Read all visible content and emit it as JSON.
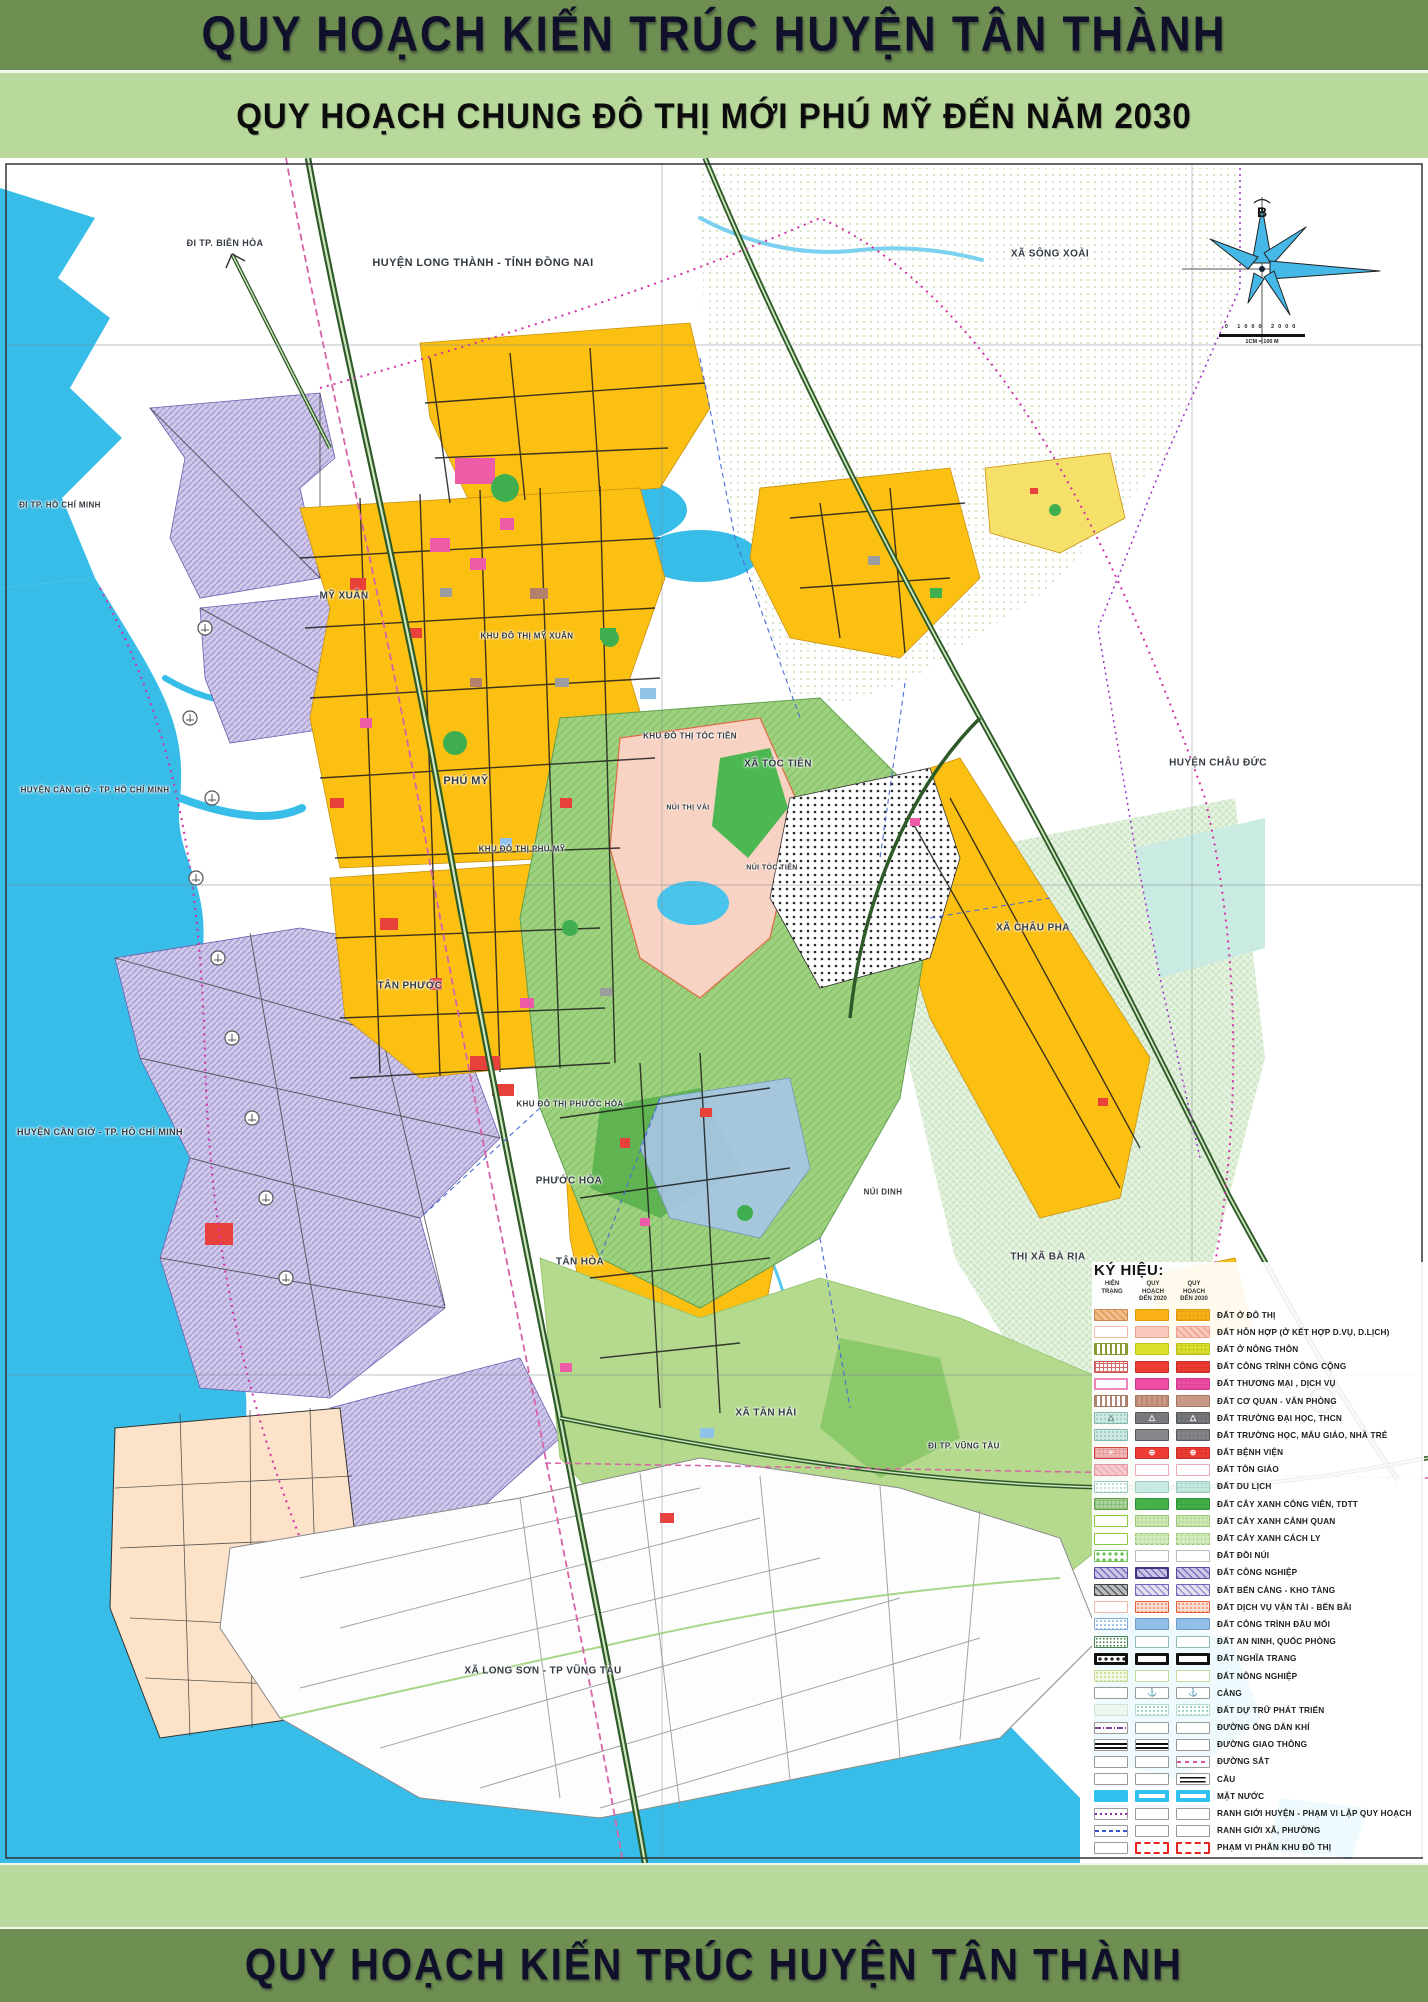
{
  "banners": {
    "top_title": "QUY HOẠCH KIẾN TRÚC HUYỆN TÂN THÀNH",
    "subtitle": "QUY HOẠCH CHUNG ĐÔ THỊ MỚI PHÚ MỸ ĐẾN NĂM 2030",
    "bottom_title": "QUY HOẠCH KIẾN TRÚC HUYỆN TÂN THÀNH"
  },
  "palette": {
    "banner_green": "#6e8f51",
    "subtitle_green": "#b9d89b",
    "water_blue": "#38bde9",
    "urban_yellow": "#fcc013",
    "industrial_lavender": "#d0c9e8",
    "forest_green": "#9ed17f",
    "boundary_magenta": "#d12fa6",
    "highway_green": "#2d5a27"
  },
  "compass": {
    "north_label": "B",
    "scale_ticks": "0  1000  2000",
    "scale_caption": "1CM = 100 M"
  },
  "map": {
    "labels": [
      {
        "text": "ĐI TP. BIÊN HÒA",
        "x": 225,
        "y": 243,
        "size": 9
      },
      {
        "text": "HUYỆN LONG THÀNH - TỈNH ĐỒNG NAI",
        "x": 483,
        "y": 263,
        "size": 11
      },
      {
        "text": "XÃ SÔNG XOÀI",
        "x": 1050,
        "y": 254,
        "size": 10
      },
      {
        "text": "ĐI TP. HỒ CHÍ MINH",
        "x": 60,
        "y": 505,
        "size": 8
      },
      {
        "text": "HUYỆN CẦN GIỜ - TP. HỒ CHÍ MINH",
        "x": 95,
        "y": 790,
        "size": 8
      },
      {
        "text": "HUYỆN CẦN GIỜ - TP. HỒ CHÍ MINH",
        "x": 100,
        "y": 1132,
        "size": 9
      },
      {
        "text": "HUYỆN CHÂU ĐỨC",
        "x": 1218,
        "y": 763,
        "size": 10
      },
      {
        "text": "MỸ XUÂN",
        "x": 344,
        "y": 596,
        "size": 10
      },
      {
        "text": "KHU ĐÔ THỊ MỸ XUÂN",
        "x": 527,
        "y": 636,
        "size": 8
      },
      {
        "text": "PHÚ MỸ",
        "x": 466,
        "y": 781,
        "size": 11
      },
      {
        "text": "KHU ĐÔ THỊ PHÚ MỸ",
        "x": 522,
        "y": 849,
        "size": 8
      },
      {
        "text": "XÃ TÓC TIÊN",
        "x": 778,
        "y": 764,
        "size": 10
      },
      {
        "text": "NÚI THỊ VẢI",
        "x": 688,
        "y": 808,
        "size": 7
      },
      {
        "text": "NÚI TÓC TIÊN",
        "x": 772,
        "y": 868,
        "size": 7
      },
      {
        "text": "KHU ĐÔ THỊ TÓC TIÊN",
        "x": 690,
        "y": 736,
        "size": 8
      },
      {
        "text": "XÃ CHÂU PHA",
        "x": 1033,
        "y": 928,
        "size": 10
      },
      {
        "text": "TÂN PHƯỚC",
        "x": 410,
        "y": 986,
        "size": 10
      },
      {
        "text": "KHU ĐÔ THỊ PHƯỚC HÒA",
        "x": 570,
        "y": 1104,
        "size": 8
      },
      {
        "text": "PHƯỚC HÒA",
        "x": 569,
        "y": 1181,
        "size": 10
      },
      {
        "text": "TÂN HÒA",
        "x": 580,
        "y": 1262,
        "size": 10
      },
      {
        "text": "NÚI DINH",
        "x": 883,
        "y": 1192,
        "size": 8
      },
      {
        "text": "THỊ XÃ BÀ RỊA",
        "x": 1048,
        "y": 1257,
        "size": 10
      },
      {
        "text": "XÃ TÂN HẢI",
        "x": 766,
        "y": 1413,
        "size": 10
      },
      {
        "text": "ĐI TP. VŨNG TÀU",
        "x": 964,
        "y": 1446,
        "size": 8
      },
      {
        "text": "XÃ LONG SƠN - TP VŨNG TÀU",
        "x": 543,
        "y": 1671,
        "size": 10
      }
    ]
  },
  "legend": {
    "heading": "KÝ HIỆU:",
    "columns": [
      "HIỆN TRẠNG",
      "QUY HOẠCH ĐẾN 2020",
      "QUY HOẠCH ĐẾN 2030"
    ],
    "rows": [
      {
        "label": "ĐẤT Ở ĐÔ THỊ",
        "swatches": [
          {
            "bg": "#f0bd8c",
            "pat": "hatch",
            "pc": "#df9a55",
            "bc": "#c98b4e"
          },
          {
            "bg": "#fbb216",
            "bc": "#d99a10"
          },
          {
            "bg": "#fbb216",
            "pat": "grid",
            "pc": "#e8a312",
            "bc": "#d99a10"
          }
        ]
      },
      {
        "label": "ĐẤT HỖN HỢP (Ở KẾT HỢP D.VỤ, D.LỊCH)",
        "swatches": [
          {
            "bg": "#ffffff",
            "bc": "#f3b8ab"
          },
          {
            "bg": "#f9c9bb",
            "bc": "#eba193"
          },
          {
            "bg": "#f9c9bb",
            "pat": "hatch",
            "pc": "#eca392",
            "bc": "#eba193"
          }
        ]
      },
      {
        "label": "ĐẤT Ở NÔNG THÔN",
        "swatches": [
          {
            "bg": "#ffffff",
            "pat": "vlines",
            "pc": "#8a9a33",
            "bc": "#8a9a33"
          },
          {
            "bg": "#dbe12c",
            "bc": "#b9c320"
          },
          {
            "bg": "#dbe12c",
            "pat": "grid",
            "pc": "#c6cd22",
            "bc": "#b9c320"
          }
        ]
      },
      {
        "label": "ĐẤT CÔNG TRÌNH CÔNG CỘNG",
        "swatches": [
          {
            "bg": "#ffffff",
            "pat": "grid",
            "pc": "#d96a6a",
            "bc": "#c65454"
          },
          {
            "bg": "#ee3d35",
            "bc": "#c52f28"
          },
          {
            "bg": "#ee3d35",
            "pat": "grid",
            "pc": "#dd342d",
            "bc": "#c52f28"
          }
        ]
      },
      {
        "label": "ĐẤT THƯƠNG MẠI , DỊCH VỤ",
        "swatches": [
          {
            "bg": "#ffffff",
            "bc": "#ef86bc",
            "bw": 2
          },
          {
            "bg": "#ee4fa4",
            "bc": "#d03a8d"
          },
          {
            "bg": "#ee4fa4",
            "pat": "grid",
            "pc": "#df4398",
            "bc": "#d03a8d"
          }
        ]
      },
      {
        "label": "ĐẤT CƠ QUAN - VĂN PHÒNG",
        "swatches": [
          {
            "bg": "#ffffff",
            "pat": "vlines",
            "pc": "#b08574",
            "bc": "#a1765f"
          },
          {
            "bg": "#c99887",
            "pat": "vlines",
            "pc": "#b9886f",
            "bc": "#a1765f"
          },
          {
            "bg": "#c99887",
            "bc": "#a1765f"
          }
        ]
      },
      {
        "label": "ĐẤT TRƯỜNG ĐẠI HỌC, THCN",
        "swatches": [
          {
            "bg": "#cfe8e3",
            "pat": "dots",
            "pc": "#9fd0c8",
            "bc": "#86b8ae",
            "sym": "△",
            "sc": "#4f7d74"
          },
          {
            "bg": "#77797c",
            "bc": "#55585a",
            "sym": "△",
            "sc": "#ffffff"
          },
          {
            "bg": "#77797c",
            "pat": "grid",
            "pc": "#6a6c6f",
            "bc": "#55585a",
            "sym": "△",
            "sc": "#ffffff"
          }
        ]
      },
      {
        "label": "ĐẤT TRƯỜNG HỌC, MẪU GIÁO, NHÀ TRẺ",
        "swatches": [
          {
            "bg": "#cfe8e3",
            "pat": "dots",
            "pc": "#9fd0c8",
            "bc": "#86b8ae"
          },
          {
            "bg": "#85878a",
            "bc": "#55585a"
          },
          {
            "bg": "#85878a",
            "pat": "grid",
            "pc": "#77797c",
            "bc": "#55585a"
          }
        ]
      },
      {
        "label": "ĐẤT BỆNH VIỆN",
        "swatches": [
          {
            "bg": "#f2b9b9",
            "pat": "grid",
            "pc": "#e79a9a",
            "bc": "#d04440",
            "sym": "+",
            "sc": "#ffffff"
          },
          {
            "bg": "#ee3d35",
            "bc": "#c52f28",
            "sym": "⊕",
            "sc": "#ffffff"
          },
          {
            "bg": "#ee3d35",
            "pat": "grid",
            "pc": "#dd342d",
            "bc": "#c52f28",
            "sym": "⊕",
            "sc": "#ffffff"
          }
        ]
      },
      {
        "label": "ĐẤT TÔN GIÁO",
        "swatches": [
          {
            "bg": "#f7c9cf",
            "pat": "hatch",
            "pc": "#eeaab4",
            "bc": "#e295a2"
          },
          {
            "bg": "#ffffff",
            "bc": "#f0a8b2"
          },
          {
            "bg": "#ffffff",
            "bc": "#f0a8b2"
          }
        ]
      },
      {
        "label": "ĐẤT DU LỊCH",
        "swatches": [
          {
            "bg": "#ffffff",
            "pat": "dots",
            "pc": "#bfe3db",
            "bc": "#9cc9c0"
          },
          {
            "bg": "#c8eae2",
            "bc": "#9cc9c0"
          },
          {
            "bg": "#c8eae2",
            "pat": "grid",
            "pc": "#b6dcd2",
            "bc": "#9cc9c0"
          }
        ]
      },
      {
        "label": "ĐẤT CÂY XANH CÔNG VIÊN, TDTT",
        "swatches": [
          {
            "bg": "#a9d39a",
            "pat": "grid",
            "pc": "#8cbf7b",
            "bc": "#5f9e4f"
          },
          {
            "bg": "#46b049",
            "bc": "#2f8f38"
          },
          {
            "bg": "#46b049",
            "pat": "grid",
            "pc": "#3da341",
            "bc": "#2f8f38"
          }
        ]
      },
      {
        "label": "ĐẤT CÂY XANH CẢNH QUAN",
        "swatches": [
          {
            "bg": "#ffffff",
            "bc": "#8cc63f"
          },
          {
            "bg": "#cde6b4",
            "pat": "dots",
            "pc": "#b5d898",
            "bc": "#9cc474"
          },
          {
            "bg": "#cde6b4",
            "pat": "dots",
            "pc": "#b5d898",
            "bc": "#9cc474"
          }
        ]
      },
      {
        "label": "ĐẤT CÂY XANH CÁCH LY",
        "swatches": [
          {
            "bg": "#ffffff",
            "bc": "#8cc63f"
          },
          {
            "bg": "#d9edc4",
            "pat": "grid",
            "pc": "#c2dfa6",
            "bc": "#9cc474",
            "bs": "dashed"
          },
          {
            "bg": "#d9edc4",
            "pat": "grid",
            "pc": "#c2dfa6",
            "bc": "#9cc474",
            "bs": "dashed"
          }
        ]
      },
      {
        "label": "ĐẤT ĐỒI NÚI",
        "swatches": [
          {
            "bg": "#ffffff",
            "pat": "bigdots",
            "pc": "#6fbf58",
            "bc": "#6fbf58"
          },
          {
            "bg": "#ffffff",
            "bc": "#bbbbbb"
          },
          {
            "bg": "#ffffff",
            "bc": "#bbbbbb"
          }
        ]
      },
      {
        "label": "ĐẤT CÔNG NGHIỆP",
        "swatches": [
          {
            "bg": "#cdc5e6",
            "pat": "hatch",
            "pc": "#7d6fbf",
            "bc": "#5b4ea0"
          },
          {
            "bg": "#cdc5e6",
            "pat": "hatch",
            "pc": "#7d6fbf",
            "bc": "#3f3580",
            "bw": 2
          },
          {
            "bg": "#cdc5e6",
            "pat": "hatch",
            "pc": "#7d6fbf",
            "bc": "#5b4ea0"
          }
        ]
      },
      {
        "label": "ĐẤT BẾN CẢNG - KHO TÀNG",
        "swatches": [
          {
            "bg": "#b9bcbf",
            "pat": "hatch",
            "pc": "#5a5e63",
            "bc": "#3c4043"
          },
          {
            "bg": "#e6e2f2",
            "pat": "hatch",
            "pc": "#9a8fd0",
            "bc": "#6f64b8"
          },
          {
            "bg": "#e6e2f2",
            "pat": "hatch",
            "pc": "#9a8fd0",
            "bc": "#6f64b8"
          }
        ]
      },
      {
        "label": "ĐẤT DỊCH VỤ VẬN TẢI - BẾN BÃI",
        "swatches": [
          {
            "bg": "#ffffff",
            "bc": "#f0b9a5"
          },
          {
            "bg": "#f8ddd0",
            "pat": "dots",
            "pc": "#ef9d7f",
            "bc": "#e4603d"
          },
          {
            "bg": "#f8ddd0",
            "pat": "dots",
            "pc": "#ef9d7f",
            "bc": "#e4603d"
          }
        ]
      },
      {
        "label": "ĐẤT CÔNG TRÌNH ĐẦU MỐI",
        "swatches": [
          {
            "bg": "#ffffff",
            "pat": "dots",
            "pc": "#9ec4ea",
            "bc": "#7fa8d4"
          },
          {
            "bg": "#92bfe8",
            "bc": "#6f9dc8"
          },
          {
            "bg": "#92bfe8",
            "bc": "#6f9dc8"
          }
        ]
      },
      {
        "label": "ĐẤT AN NINH, QUỐC PHÒNG",
        "swatches": [
          {
            "bg": "#ffffff",
            "pat": "speckle",
            "pc": "#4c7f52",
            "bc": "#4c7f52"
          },
          {
            "bg": "#ffffff",
            "bc": "#8fbcb2"
          },
          {
            "bg": "#ffffff",
            "bc": "#8fbcb2"
          }
        ]
      },
      {
        "label": "ĐẤT NGHĨA TRANG",
        "swatches": [
          {
            "bg": "#ffffff",
            "pat": "bigdots",
            "pc": "#222222",
            "bc": "#111111",
            "bw": 3
          },
          {
            "bg": "#ffffff",
            "bc": "#111111",
            "bw": 3
          },
          {
            "bg": "#ffffff",
            "bc": "#111111",
            "bw": 3
          }
        ]
      },
      {
        "label": "ĐẤT NÔNG NGHIỆP",
        "swatches": [
          {
            "bg": "#f4f9e4",
            "pat": "dots",
            "pc": "#cde29f",
            "bc": "#c4da9a"
          },
          {
            "bg": "#ffffff",
            "bc": "#c4da9a"
          },
          {
            "bg": "#ffffff",
            "bc": "#c4da9a"
          }
        ]
      },
      {
        "label": "CẢNG",
        "swatches": [
          {
            "bg": "#ffffff",
            "bc": "#999999"
          },
          {
            "bg": "#ffffff",
            "bc": "#999999",
            "sym": "⚓",
            "sc": "#2b3f9e"
          },
          {
            "bg": "#ffffff",
            "bc": "#999999",
            "sym": "⚓",
            "sc": "#2b3f9e"
          }
        ]
      },
      {
        "label": "ĐẤT DỰ TRỮ PHÁT TRIỂN",
        "swatches": [
          {
            "bg": "#eef7ef",
            "bc": "#cfe3cf"
          },
          {
            "bg": "#ffffff",
            "pat": "dots",
            "pc": "#9fd4c4",
            "bc": "#b9d9cd"
          },
          {
            "bg": "#ffffff",
            "pat": "dots",
            "pc": "#9fd4c4",
            "bc": "#b9d9cd"
          }
        ]
      },
      {
        "label": "ĐƯỜNG ỐNG DẪN KHÍ",
        "swatches": [
          {
            "bg": "#ffffff",
            "bc": "#999999",
            "pat": "gasline",
            "pc": "#7d3f98"
          },
          {
            "bg": "#ffffff",
            "bc": "#999999"
          },
          {
            "bg": "#ffffff",
            "bc": "#999999"
          }
        ]
      },
      {
        "label": "ĐƯỜNG GIAO THÔNG",
        "swatches": [
          {
            "bg": "#ffffff",
            "bc": "#999999",
            "pat": "roadsym",
            "pc": "#111111"
          },
          {
            "bg": "#ffffff",
            "bc": "#999999",
            "pat": "roadsym",
            "pc": "#111111"
          },
          {
            "bg": "#ffffff",
            "bc": "#999999"
          }
        ]
      },
      {
        "label": "ĐƯỜNG SẮT",
        "swatches": [
          {
            "bg": "#ffffff",
            "bc": "#999999"
          },
          {
            "bg": "#ffffff",
            "bc": "#999999"
          },
          {
            "bg": "#ffffff",
            "bc": "#999999",
            "pat": "raildash",
            "pc": "#e0529e"
          }
        ]
      },
      {
        "label": "CẦU",
        "swatches": [
          {
            "bg": "#ffffff",
            "bc": "#999999"
          },
          {
            "bg": "#ffffff",
            "bc": "#999999"
          },
          {
            "bg": "#ffffff",
            "bc": "#999999",
            "pat": "bridgesym",
            "pc": "#111111"
          }
        ]
      },
      {
        "label": "MẶT NƯỚC",
        "swatches": [
          {
            "bg": "#2fc1ef",
            "bc": "#2fc1ef",
            "bw": 2
          },
          {
            "bg": "#ffffff",
            "bc": "#2fc1ef",
            "bw": 4
          },
          {
            "bg": "#ffffff",
            "bc": "#2fc1ef",
            "bw": 4
          }
        ]
      },
      {
        "label": "RANH GIỚI HUYỆN - PHẠM VI LẬP QUY HOẠCH",
        "swatches": [
          {
            "bg": "#ffffff",
            "bc": "#999999",
            "pat": "dotline",
            "pc": "#8a2fa8"
          },
          {
            "bg": "#ffffff",
            "bc": "#999999"
          },
          {
            "bg": "#ffffff",
            "bc": "#999999"
          }
        ]
      },
      {
        "label": "RANH GIỚI XÃ, PHƯỜNG",
        "swatches": [
          {
            "bg": "#ffffff",
            "bc": "#999999",
            "pat": "dashline",
            "pc": "#3a55c8"
          },
          {
            "bg": "#ffffff",
            "bc": "#999999"
          },
          {
            "bg": "#ffffff",
            "bc": "#999999"
          }
        ]
      },
      {
        "label": "PHẠM VI PHÂN KHU ĐÔ THỊ",
        "swatches": [
          {
            "bg": "#ffffff",
            "bc": "#999999"
          },
          {
            "bg": "#ffffff",
            "bc": "#e8251d",
            "bs": "dashed",
            "bw": 2
          },
          {
            "bg": "#ffffff",
            "bc": "#e8251d",
            "bs": "dashed",
            "bw": 2
          }
        ]
      }
    ]
  }
}
